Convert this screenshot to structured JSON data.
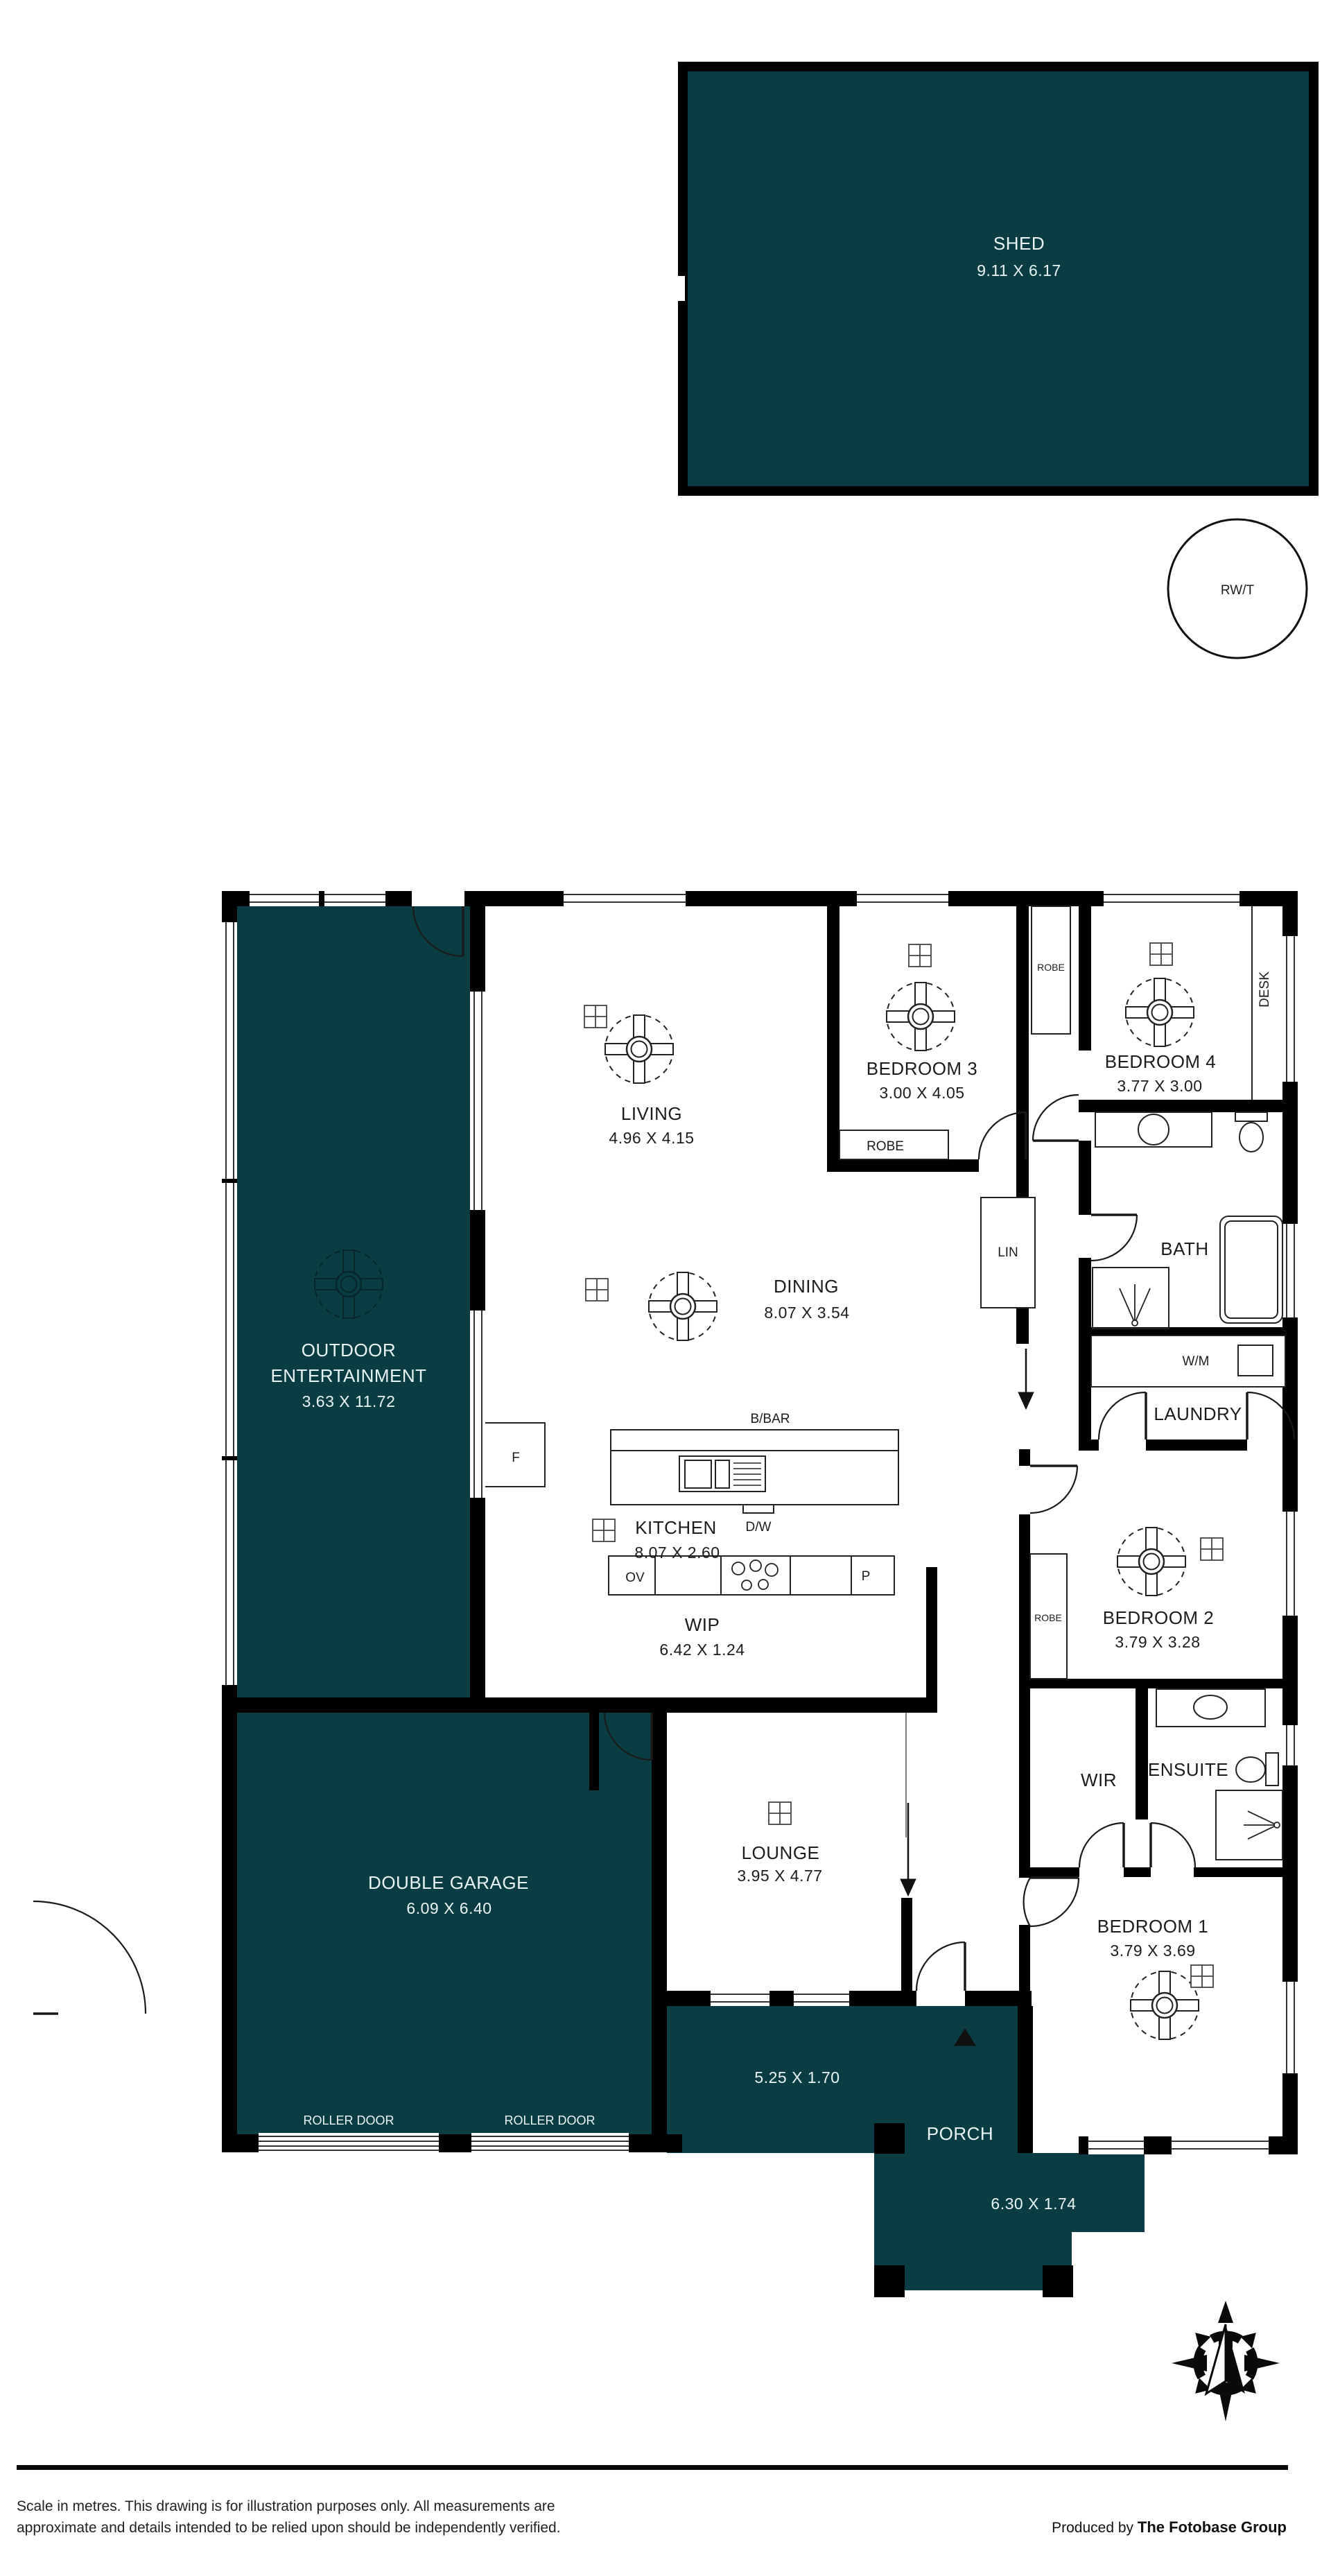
{
  "colors": {
    "room_fill": "#0a3d43",
    "wall": "#000000",
    "paper": "#ffffff",
    "ink": "#1c1c1c",
    "teal_text": "#e9f5f5"
  },
  "rooms": {
    "shed": {
      "name": "SHED",
      "dim": "9.11 X 6.17"
    },
    "outdoor": {
      "name_line1": "OUTDOOR",
      "name_line2": "ENTERTAINMENT",
      "dim": "3.63 X 11.72"
    },
    "living": {
      "name": "LIVING",
      "dim": "4.96 X 4.15"
    },
    "dining": {
      "name": "DINING",
      "dim": "8.07 X 3.54"
    },
    "kitchen": {
      "name": "KITCHEN",
      "dim": "8.07 X 2.60"
    },
    "wip": {
      "name": "WIP",
      "dim": "6.42 X 1.24"
    },
    "bedroom3": {
      "name": "BEDROOM 3",
      "dim": "3.00 X 4.05"
    },
    "bedroom4": {
      "name": "BEDROOM 4",
      "dim": "3.77 X 3.00"
    },
    "bath": {
      "name": "BATH"
    },
    "laundry": {
      "name": "LAUNDRY"
    },
    "bedroom2": {
      "name": "BEDROOM 2",
      "dim": "3.79 X 3.28"
    },
    "wir": {
      "name": "WIR"
    },
    "ensuite": {
      "name": "ENSUITE"
    },
    "bedroom1": {
      "name": "BEDROOM 1",
      "dim": "3.79 X 3.69"
    },
    "garage": {
      "name": "DOUBLE GARAGE",
      "dim": "6.09 X 6.40"
    },
    "lounge": {
      "name": "LOUNGE",
      "dim": "3.95 X 4.77"
    },
    "porch": {
      "name": "PORCH",
      "dim_upper": "5.25 X 1.70",
      "dim_lower": "6.30 X 1.74"
    }
  },
  "fixtures": {
    "rwt": "RW/T",
    "robe": "ROBE",
    "lin": "LIN",
    "desk": "DESK",
    "wm": "W/M",
    "bbar": "B/BAR",
    "dw": "D/W",
    "ov": "OV",
    "p": "P",
    "f": "F",
    "roller_door": "ROLLER DOOR"
  },
  "compass": {
    "north": "N"
  },
  "footer": {
    "line1": "Scale in metres. This drawing is for illustration purposes only. All measurements are",
    "line2": "approximate and details intended to be relied upon should be independently verified.",
    "credit_prefix": "Produced by ",
    "credit_brand": "The Fotobase Group"
  }
}
